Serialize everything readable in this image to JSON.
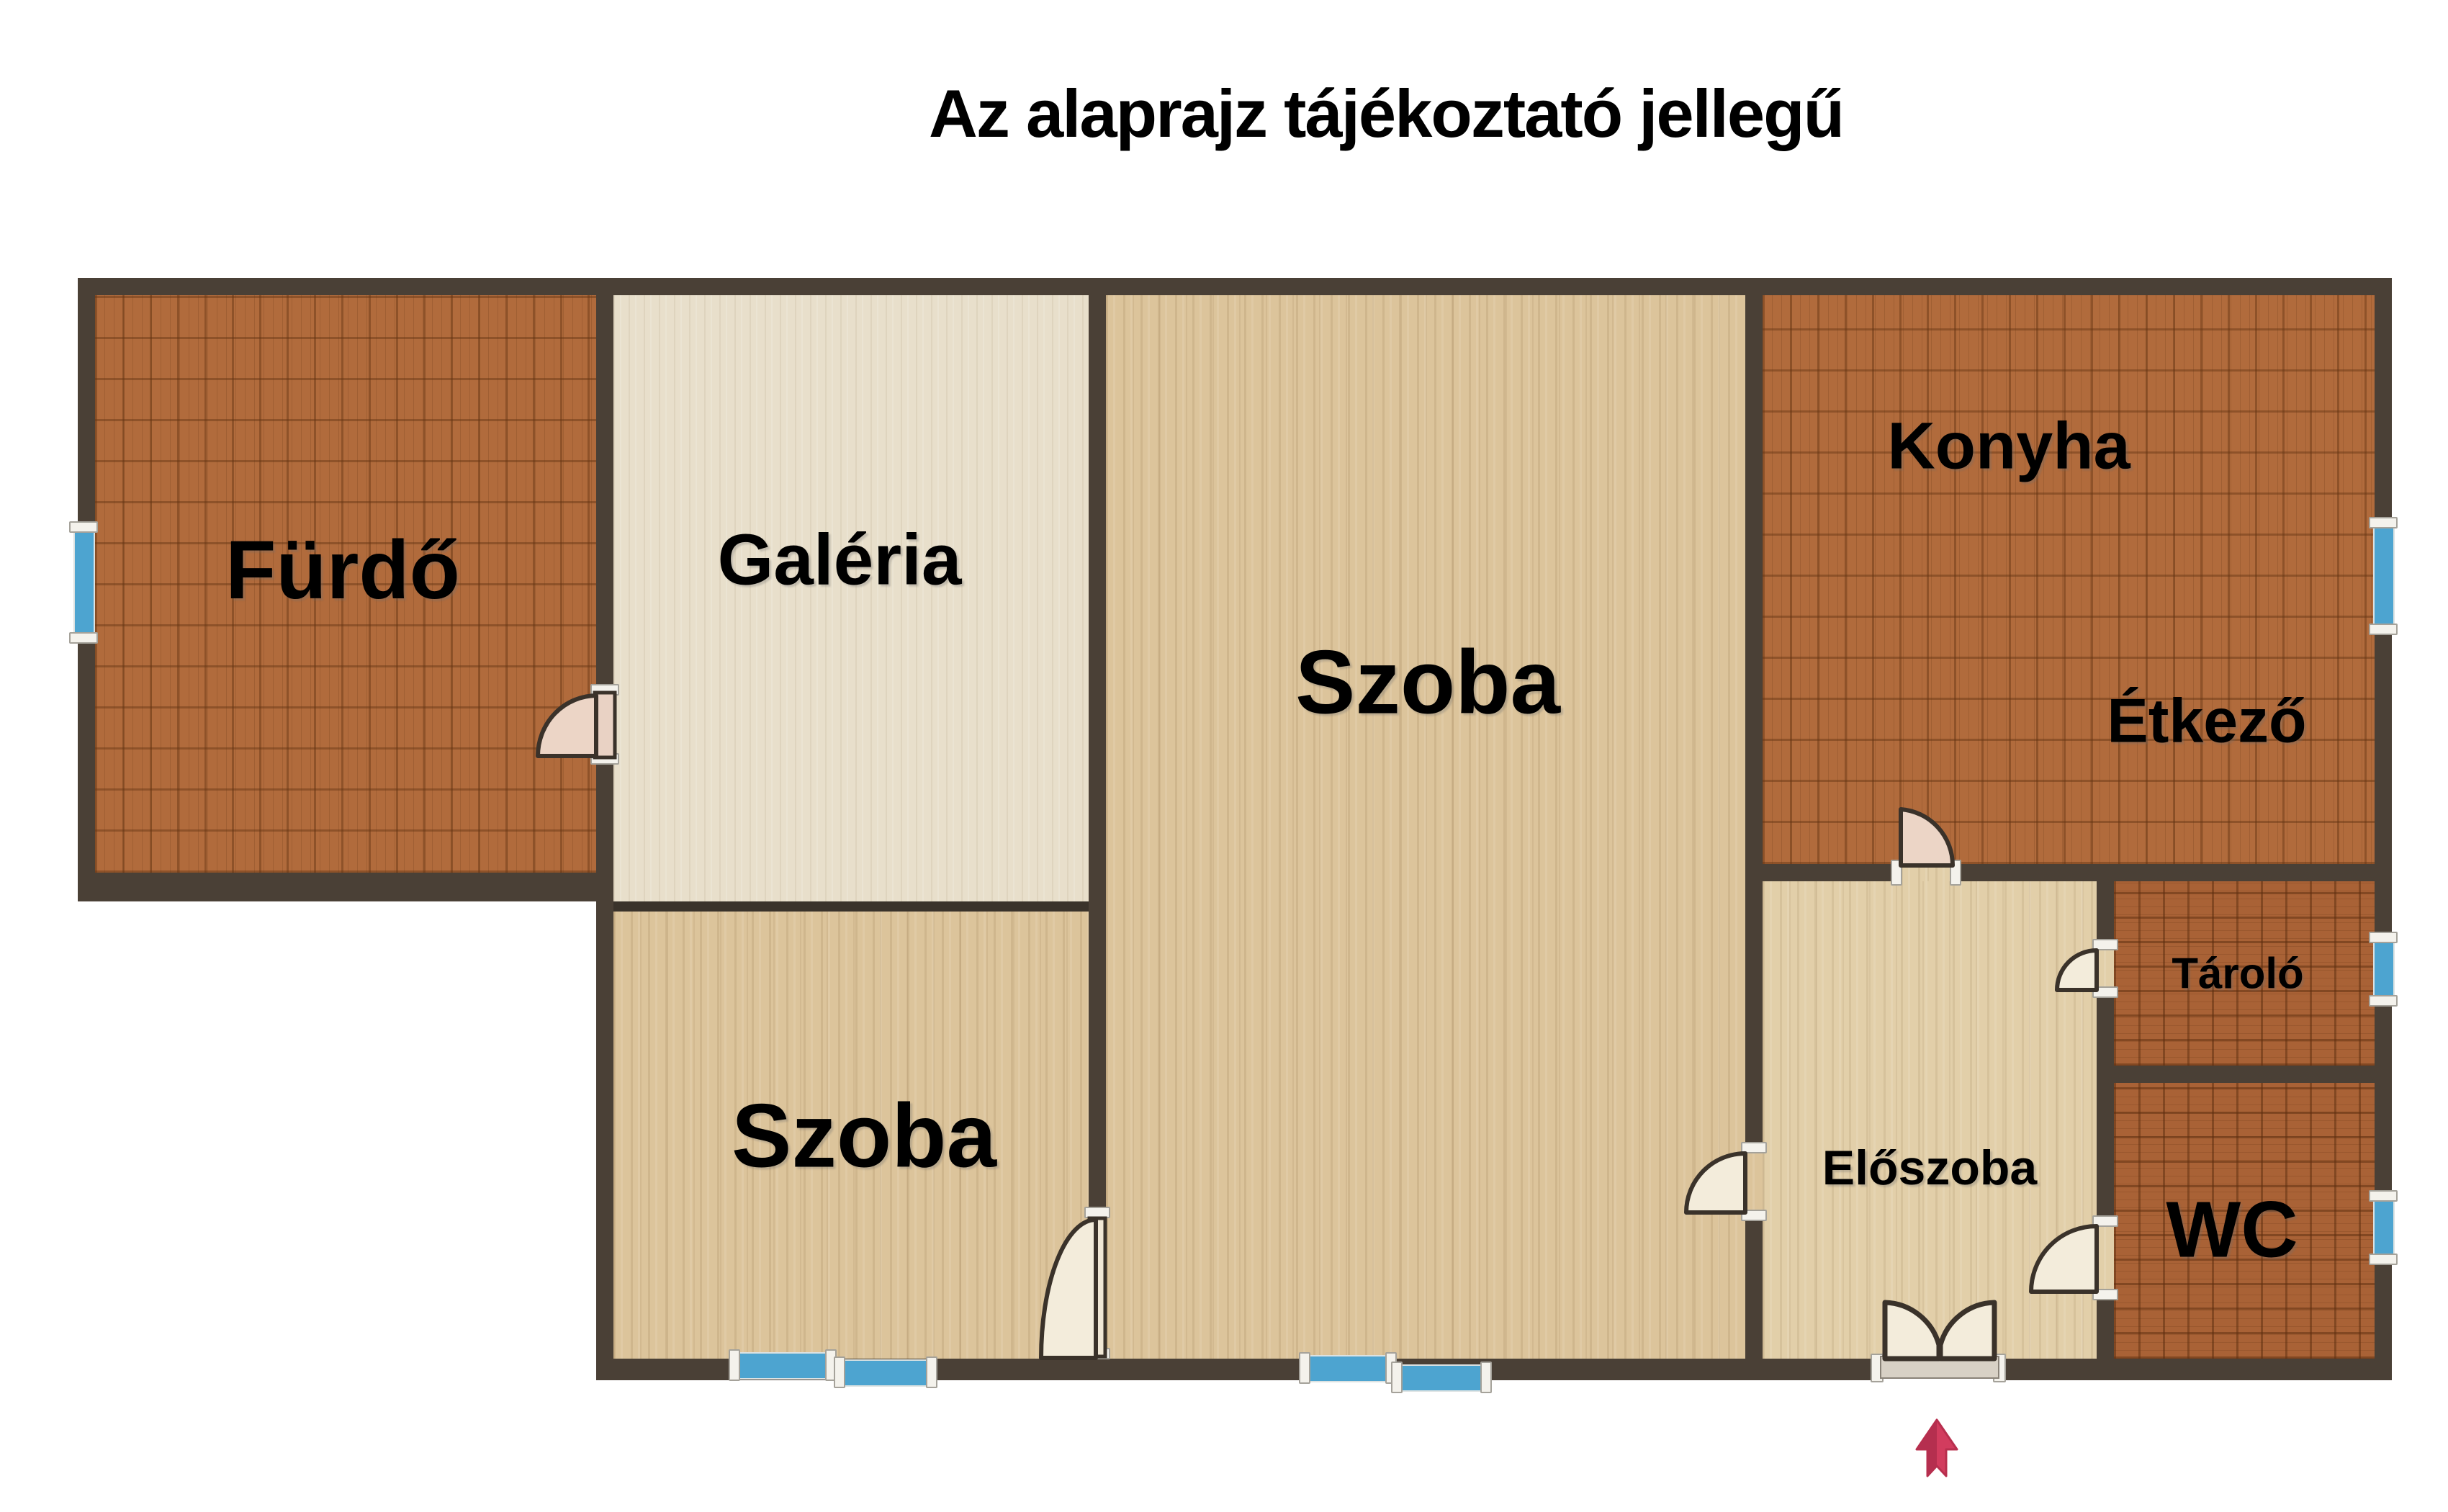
{
  "title": "Az alaprajz tájékoztató jellegű",
  "rooms": {
    "furdo": {
      "label": "Fürdő"
    },
    "galeria": {
      "label": "Galéria"
    },
    "szoba_nagy": {
      "label": "Szoba"
    },
    "szoba_also": {
      "label": "Szoba"
    },
    "konyha": {
      "label": "Konyha"
    },
    "etkezo": {
      "label": "Étkező"
    },
    "tarolo": {
      "label": "Tároló"
    },
    "eloszoba": {
      "label": "Előszoba"
    },
    "wc": {
      "label": "WC"
    }
  },
  "icons": {
    "entrance_arrow": "up-arrow"
  },
  "colors": {
    "wall": "#4a4036",
    "tile_floor": "#b16b3c",
    "tile_floor_dark": "#a96236",
    "wood_floor": "#dcc49b",
    "wood_floor_light": "#e8dfcb",
    "window": "#4da4d0",
    "door_leaf": "#f3ecdb",
    "arrow": "#d23c5e",
    "text": "#000000"
  }
}
